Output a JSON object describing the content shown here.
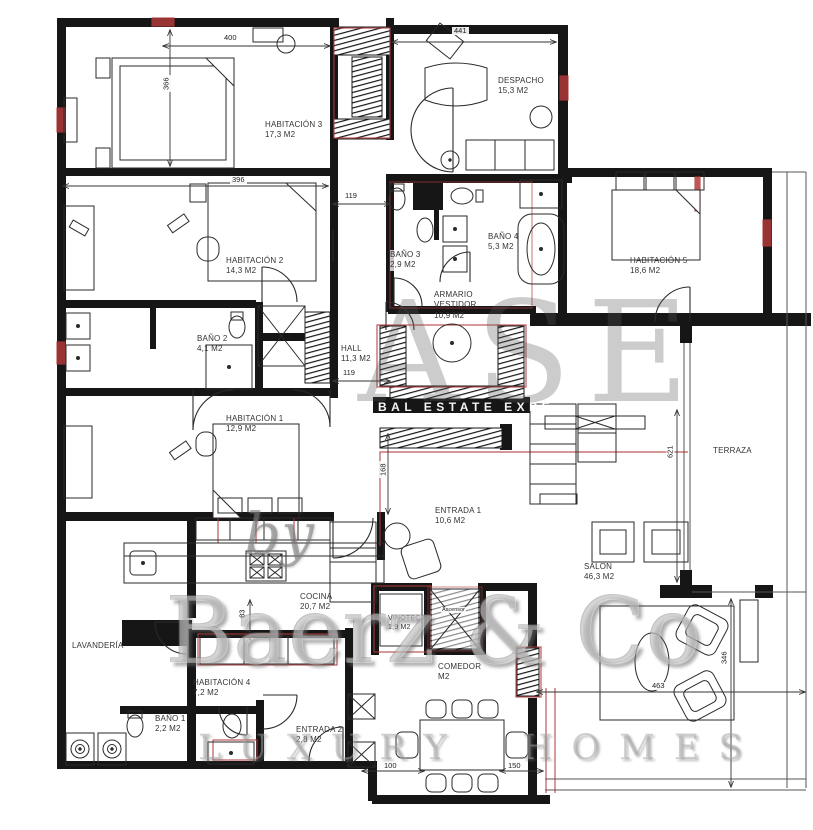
{
  "rooms": [
    {
      "name": "HABITACIÓN 3",
      "area": "17,3 M2"
    },
    {
      "name": "DESPACHO",
      "area": "15,3 M2"
    },
    {
      "name": "HABITACIÓN 2",
      "area": "14,3 M2"
    },
    {
      "name": "BAÑO 2",
      "area": "4,1 M2"
    },
    {
      "name": "BAÑO 3",
      "area": "2,9 M2"
    },
    {
      "name": "BAÑO 4",
      "area": "5,3 M2"
    },
    {
      "name": "HABITACIÓN 5",
      "area": "18,6 M2"
    },
    {
      "name": "ARMARIO VESTIDOR",
      "area": "10,9 M2"
    },
    {
      "name": "HALL",
      "area": "11,3 M2"
    },
    {
      "name": "HABITACIÓN 1",
      "area": "12,9 M2"
    },
    {
      "name": "ENTRADA 1",
      "area": "10,6 M2"
    },
    {
      "name": "SALON",
      "area": "46,3 M2"
    },
    {
      "name": "TERRAZA",
      "area": ""
    },
    {
      "name": "COCINA",
      "area": "20,7 M2"
    },
    {
      "name": "VINOTECA",
      "area": "1,9 M2"
    },
    {
      "name": "LAVANDERÍA",
      "area": ""
    },
    {
      "name": "HABITACIÓN 4",
      "area": "7,2 M2"
    },
    {
      "name": "BAÑO 1",
      "area": "2,2 M2"
    },
    {
      "name": "ENTRADA 2",
      "area": "2,8 M2"
    },
    {
      "name": "COMEDOR",
      "area": "M2"
    }
  ],
  "elevator_label": "Ascensor",
  "dimensions": {
    "d400": "400",
    "d441": "441",
    "d366": "366",
    "d396": "396",
    "d119a": "119",
    "d119b": "119",
    "d168": "168",
    "d621": "621",
    "d83": "83",
    "d100": "100",
    "d150": "150",
    "d463": "463",
    "d346": "346"
  },
  "watermark": {
    "ghost": "ASE",
    "by": "by",
    "brand": "Baerz & Co",
    "tagline": "LUXURY HOMES",
    "band_fragment": "BAL ESTATE EXPE"
  },
  "colors": {
    "wall": "#161616",
    "accent_red": "#b13a3a",
    "watermark_gray": "#9a9a9a"
  }
}
